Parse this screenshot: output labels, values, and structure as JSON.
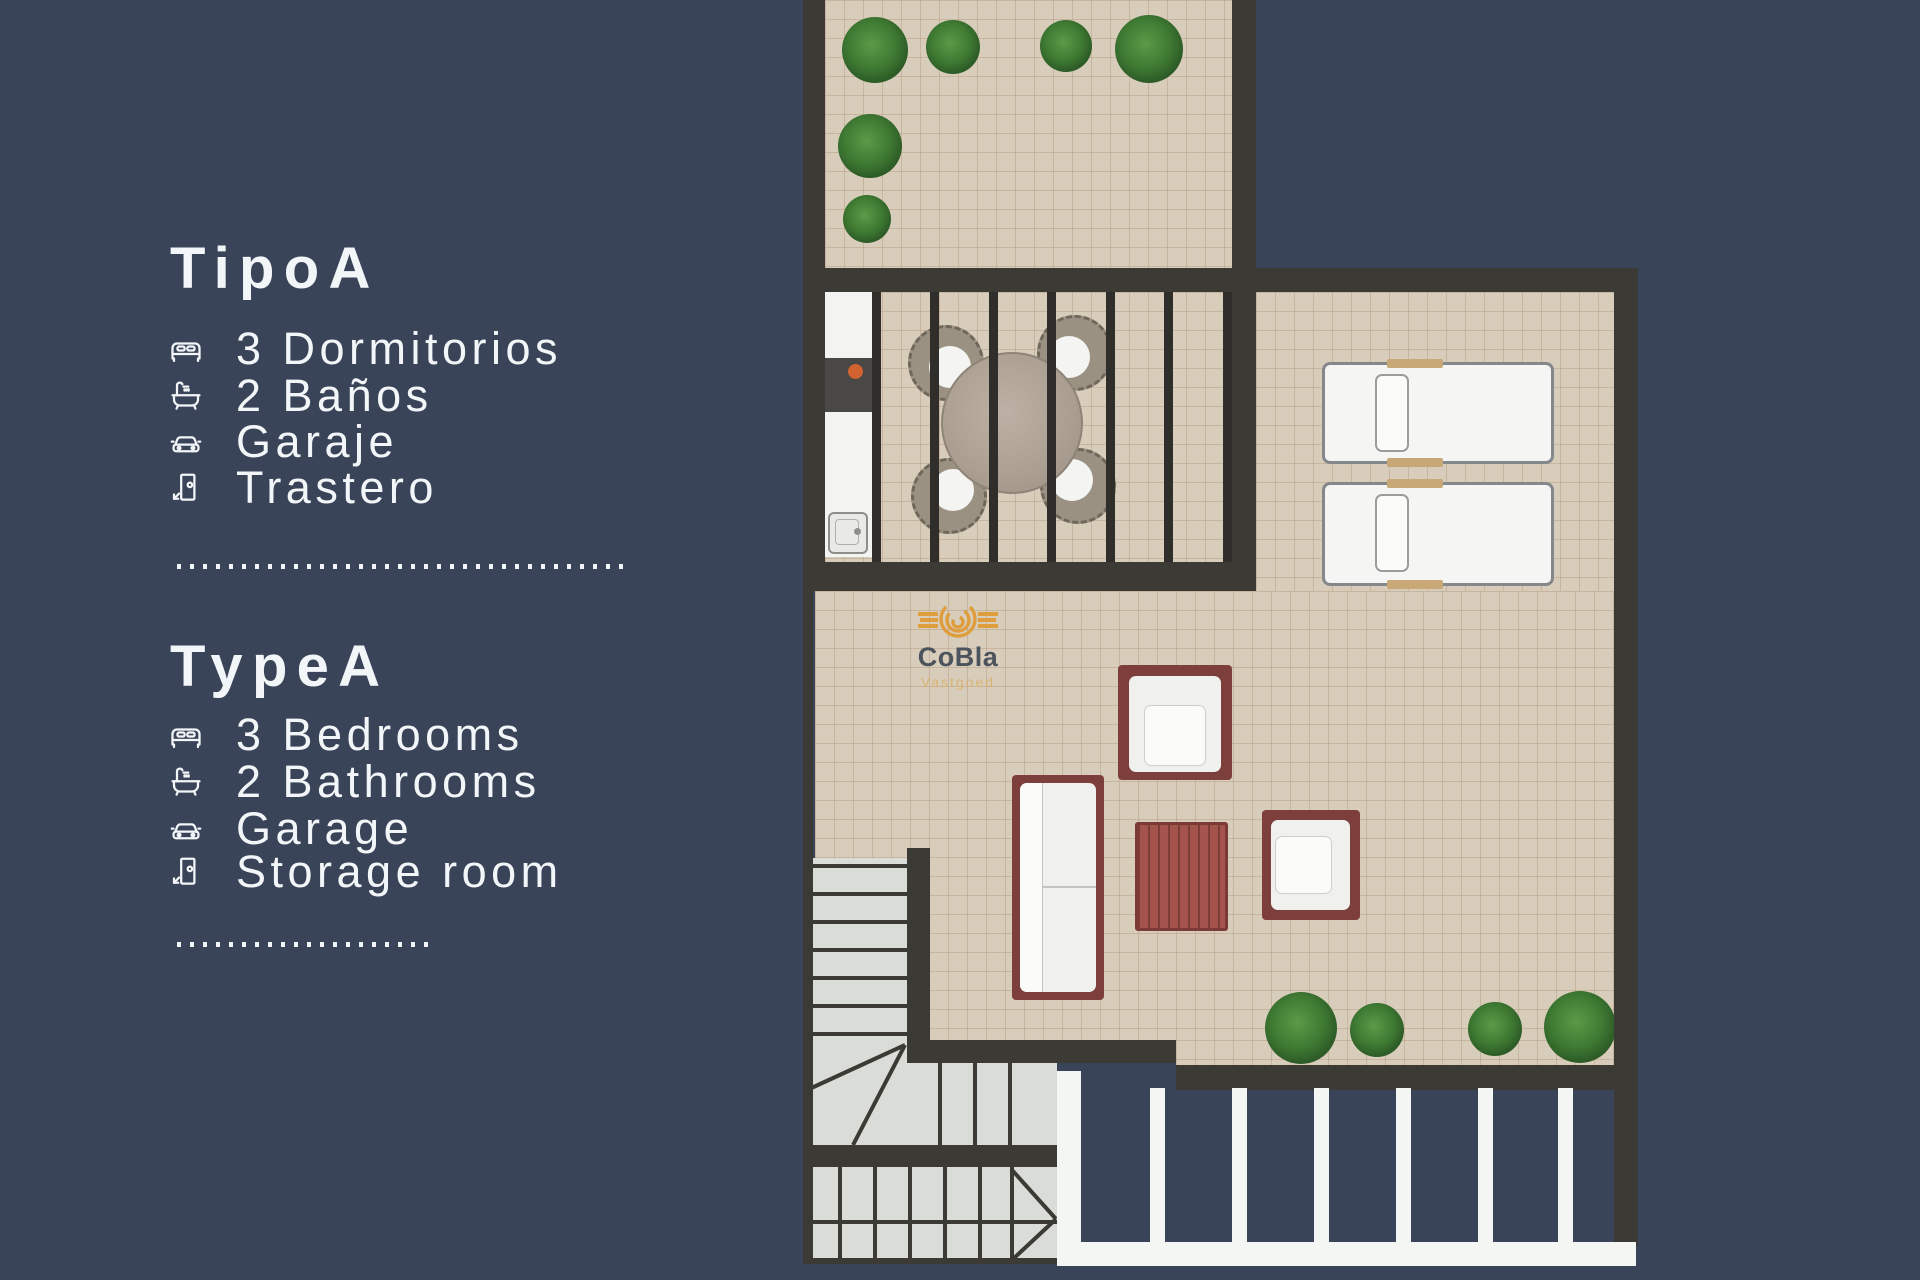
{
  "info_panel": {
    "tipo": {
      "heading": "TipoA",
      "items": [
        {
          "icon": "bed-icon",
          "label": "3 Dormitorios"
        },
        {
          "icon": "bathtub-icon",
          "label": "2 Baños"
        },
        {
          "icon": "car-icon",
          "label": "Garaje"
        },
        {
          "icon": "door-icon",
          "label": "Trastero"
        }
      ]
    },
    "type": {
      "heading": "TypeA",
      "items": [
        {
          "icon": "bed-icon",
          "label": "3 Bedrooms"
        },
        {
          "icon": "bathtub-icon",
          "label": "2 Bathrooms"
        },
        {
          "icon": "car-icon",
          "label": "Garage"
        },
        {
          "icon": "door-icon",
          "label": "Storage room"
        }
      ]
    }
  },
  "floorplan": {
    "watermark": {
      "brand": "CoBla",
      "subtitle": "Vastgoed"
    }
  },
  "colors": {
    "background": "#3a4459",
    "wall": "#3b3a35",
    "tile": "#d8ccbb",
    "furniture_frame": "#7d3f3c",
    "text": "#f3f6f8",
    "logo_orange": "#df9e3e",
    "logo_subtitle": "#d9b168"
  }
}
